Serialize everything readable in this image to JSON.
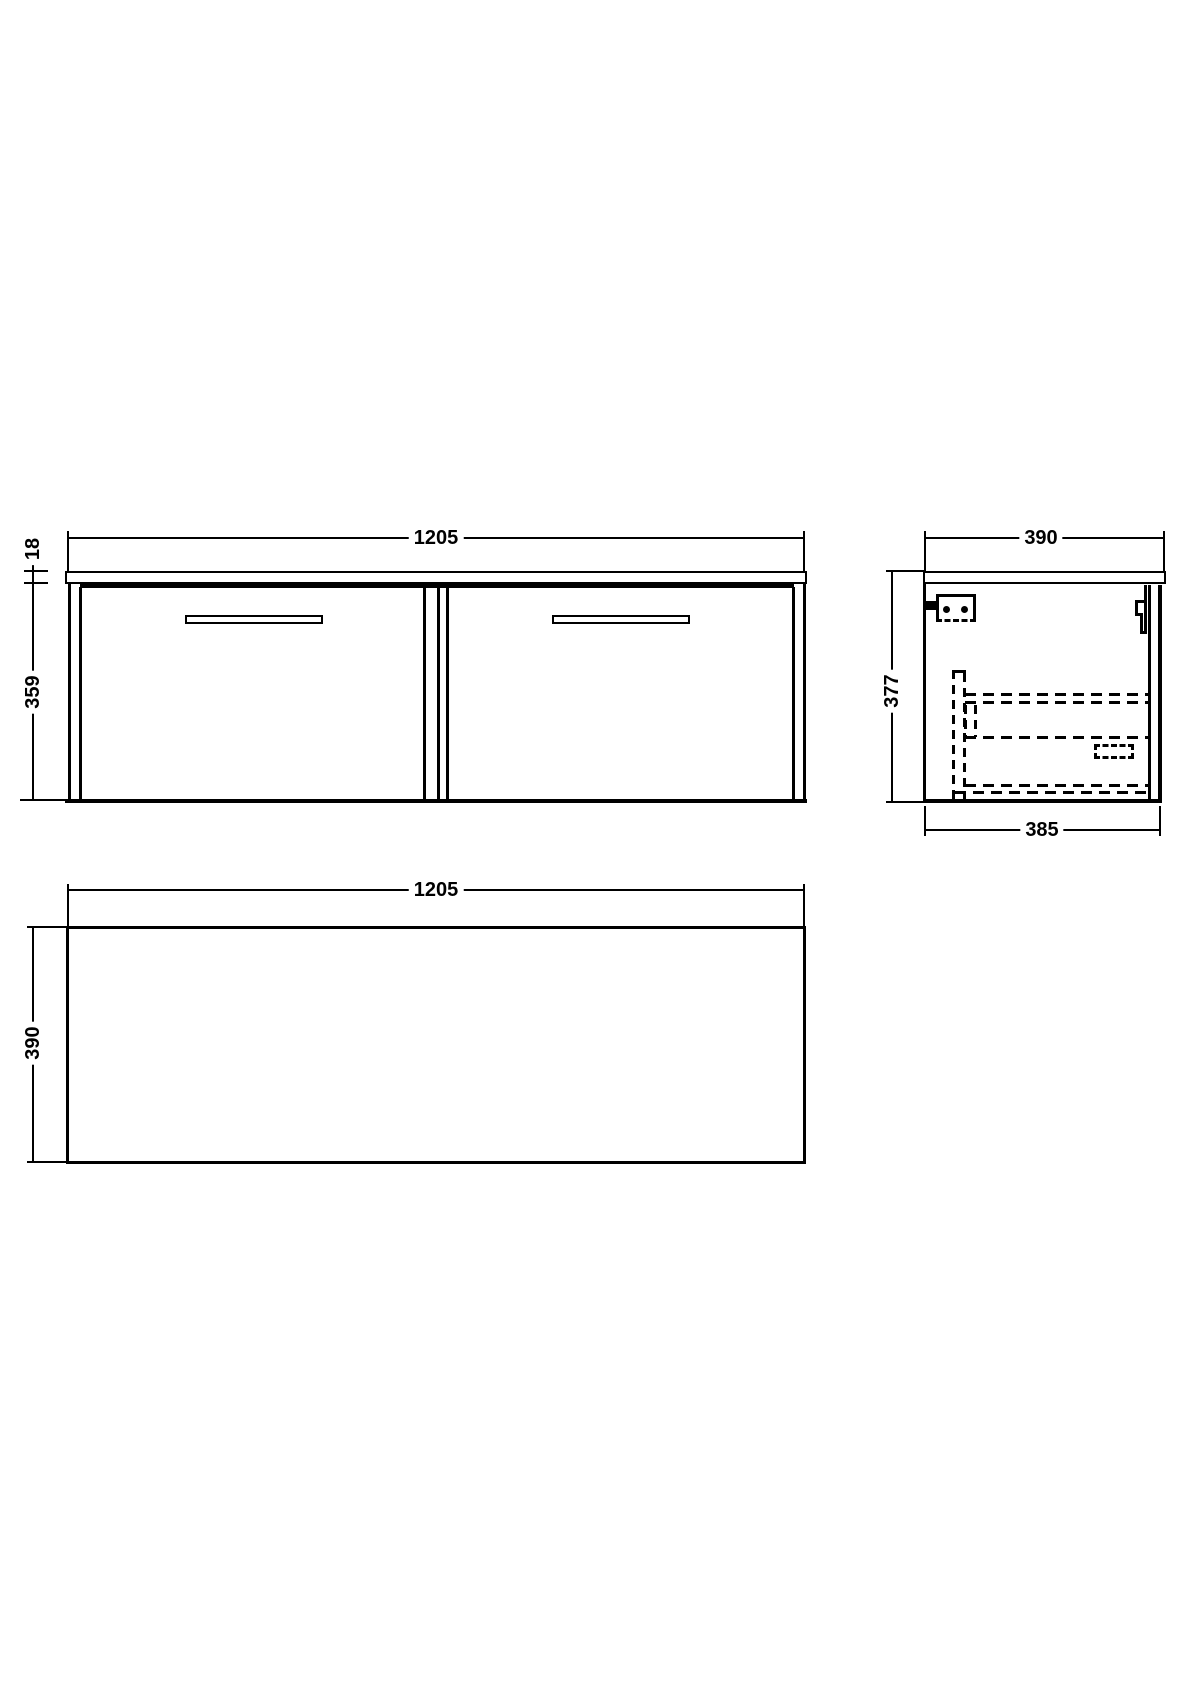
{
  "views": {
    "front": {
      "width_label": "1205",
      "worktop_thickness_label": "18",
      "cabinet_height_label": "359"
    },
    "side": {
      "depth_label": "390",
      "height_label": "377",
      "body_depth_label": "385"
    },
    "plan": {
      "width_label": "1205",
      "depth_label": "390"
    }
  },
  "colors": {
    "line": "#000000",
    "background": "#ffffff"
  }
}
